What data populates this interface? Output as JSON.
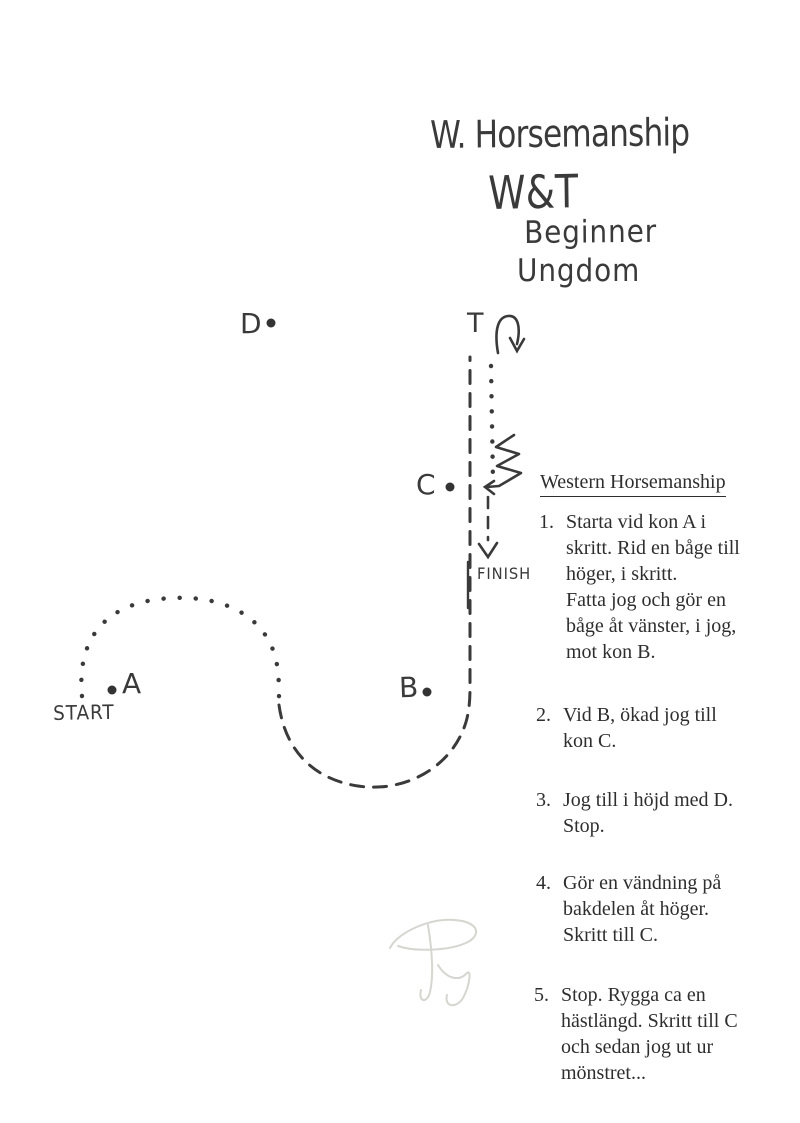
{
  "title": {
    "line1": "W. Horsemanship",
    "line2": "W&T",
    "line3": "Beginner",
    "line4": "Ungdom"
  },
  "course": {
    "start_label": "START",
    "finish_label": "FINISH",
    "turn_marker": "T",
    "cones": [
      {
        "label": "A"
      },
      {
        "label": "B"
      },
      {
        "label": "C"
      },
      {
        "label": "D"
      }
    ]
  },
  "instructions": {
    "heading": "Western Horsemanship",
    "items": [
      {
        "num": "1.",
        "text": "Starta vid kon A i\nskritt. Rid en båge till\nhöger, i skritt.\nFatta jog och gör en\nbåge åt vänster, i jog,\nmot kon B."
      },
      {
        "num": "2.",
        "text": "Vid B, ökad jog till\nkon C."
      },
      {
        "num": "3.",
        "text": "Jog till i höjd med D.\nStop."
      },
      {
        "num": "4.",
        "text": "Gör en vändning på\nbakdelen åt höger.\nSkritt till C."
      },
      {
        "num": "5.",
        "text": "Stop. Rygga ca en\nhästlängd. Skritt till C\noch sedan jog ut ur\nmönstret..."
      }
    ]
  },
  "colors": {
    "paper": "#ffffff",
    "typed_ink": "#2e2e2e",
    "hand_ink": "#3a3a3a",
    "signature": "#d6d6d0"
  }
}
